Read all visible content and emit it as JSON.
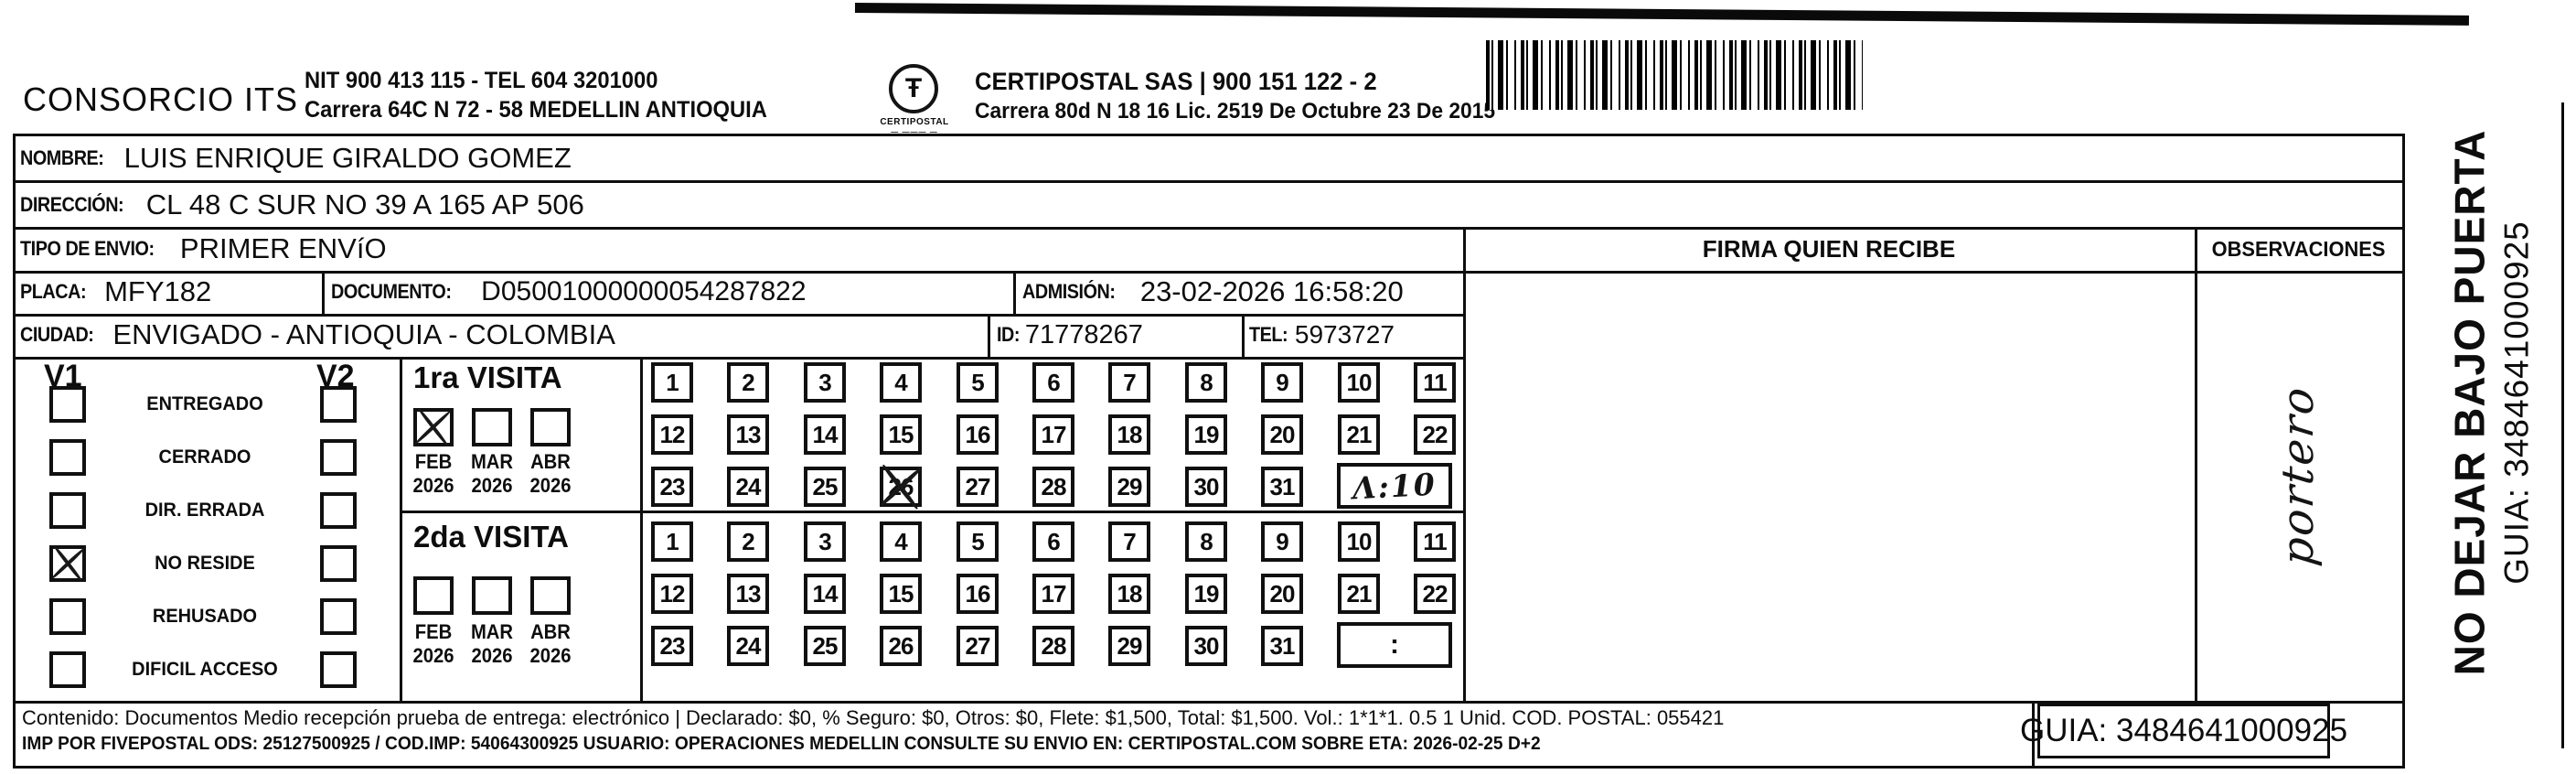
{
  "header": {
    "company": "CONSORCIO ITS",
    "info1": "NIT 900 413 115 - TEL 604 3201000",
    "info2": "Carrera 64C N 72 - 58 MEDELLIN ANTIOQUIA",
    "logo_glyph": "Ŧ",
    "logo_word": "CERTIPOSTAL",
    "logo_under": "— ——— —",
    "certi1": "CERTIPOSTAL SAS | 900 151 122 - 2",
    "certi2": "Carrera 80d N 18 16  Lic. 2519 De Octubre 23 De 2015"
  },
  "recipient": {
    "nombre_label": "NOMBRE:",
    "nombre": "LUIS ENRIQUE GIRALDO GOMEZ",
    "direccion_label": "DIRECCIÓN:",
    "direccion": "CL 48 C SUR NO 39 A 165 AP 506",
    "tipo_label": "TIPO DE ENVIO:",
    "tipo": "PRIMER ENVíO",
    "placa_label": "PLACA:",
    "placa": "MFY182",
    "documento_label": "DOCUMENTO:",
    "documento": "D05001000000054287822",
    "admision_label": "ADMISIÓN:",
    "admision": "23-02-2026 16:58:20",
    "ciudad_label": "CIUDAD:",
    "ciudad": "ENVIGADO - ANTIOQUIA - COLOMBIA",
    "id_label": "ID:",
    "id": "71778267",
    "tel_label": "TEL:",
    "tel": "5973727"
  },
  "status_panel": {
    "col1_header": "V1",
    "col2_header": "V2",
    "rows": [
      {
        "label": "ENTREGADO",
        "v1": false,
        "v2": false
      },
      {
        "label": "CERRADO",
        "v1": false,
        "v2": false
      },
      {
        "label": "DIR. ERRADA",
        "v1": false,
        "v2": false
      },
      {
        "label": "NO RESIDE",
        "v1": true,
        "v2": false
      },
      {
        "label": "REHUSADO",
        "v1": false,
        "v2": false
      },
      {
        "label": "DIFICIL ACCESO",
        "v1": false,
        "v2": false
      }
    ]
  },
  "visits": {
    "days": [
      "1",
      "2",
      "3",
      "4",
      "5",
      "6",
      "7",
      "8",
      "9",
      "10",
      "11",
      "12",
      "13",
      "14",
      "15",
      "16",
      "17",
      "18",
      "19",
      "20",
      "21",
      "22",
      "23",
      "24",
      "25",
      "26",
      "27",
      "28",
      "29",
      "30",
      "31"
    ],
    "first": {
      "title": "1ra VISITA",
      "months": [
        {
          "month": "FEB",
          "year": "2026",
          "checked": true
        },
        {
          "month": "MAR",
          "year": "2026",
          "checked": false
        },
        {
          "month": "ABR",
          "year": "2026",
          "checked": false
        }
      ],
      "crossed_day": 26,
      "time": "Λ:10",
      "time_handwritten": true
    },
    "second": {
      "title": "2da VISITA",
      "months": [
        {
          "month": "FEB",
          "year": "2026",
          "checked": false
        },
        {
          "month": "MAR",
          "year": "2026",
          "checked": false
        },
        {
          "month": "ABR",
          "year": "2026",
          "checked": false
        }
      ],
      "crossed_day": null,
      "time": ":",
      "time_handwritten": false
    }
  },
  "signature": {
    "firma_header": "FIRMA QUIEN RECIBE",
    "observaciones_header": "OBSERVACIONES",
    "observaciones_handwritten": "portero"
  },
  "footer": {
    "line1": "Contenido: Documentos Medio recepción prueba de entrega: electrónico | Declarado: $0, % Seguro: $0, Otros: $0, Flete: $1,500, Total: $1,500. Vol.: 1*1*1. 0.5  1 Unid. COD. POSTAL: 055421",
    "line2": "IMP POR FIVEPOSTAL ODS: 25127500925 / COD.IMP: 54064300925 USUARIO: OPERACIONES MEDELLIN CONSULTE SU ENVIO EN: CERTIPOSTAL.COM SOBRE ETA: 2026-02-25 D+2",
    "guia": "GUIA: 3484641000925"
  },
  "side_note": {
    "line1": "NO DEJAR BAJO PUERTA",
    "line2": "GUIA: 3484641000925"
  }
}
